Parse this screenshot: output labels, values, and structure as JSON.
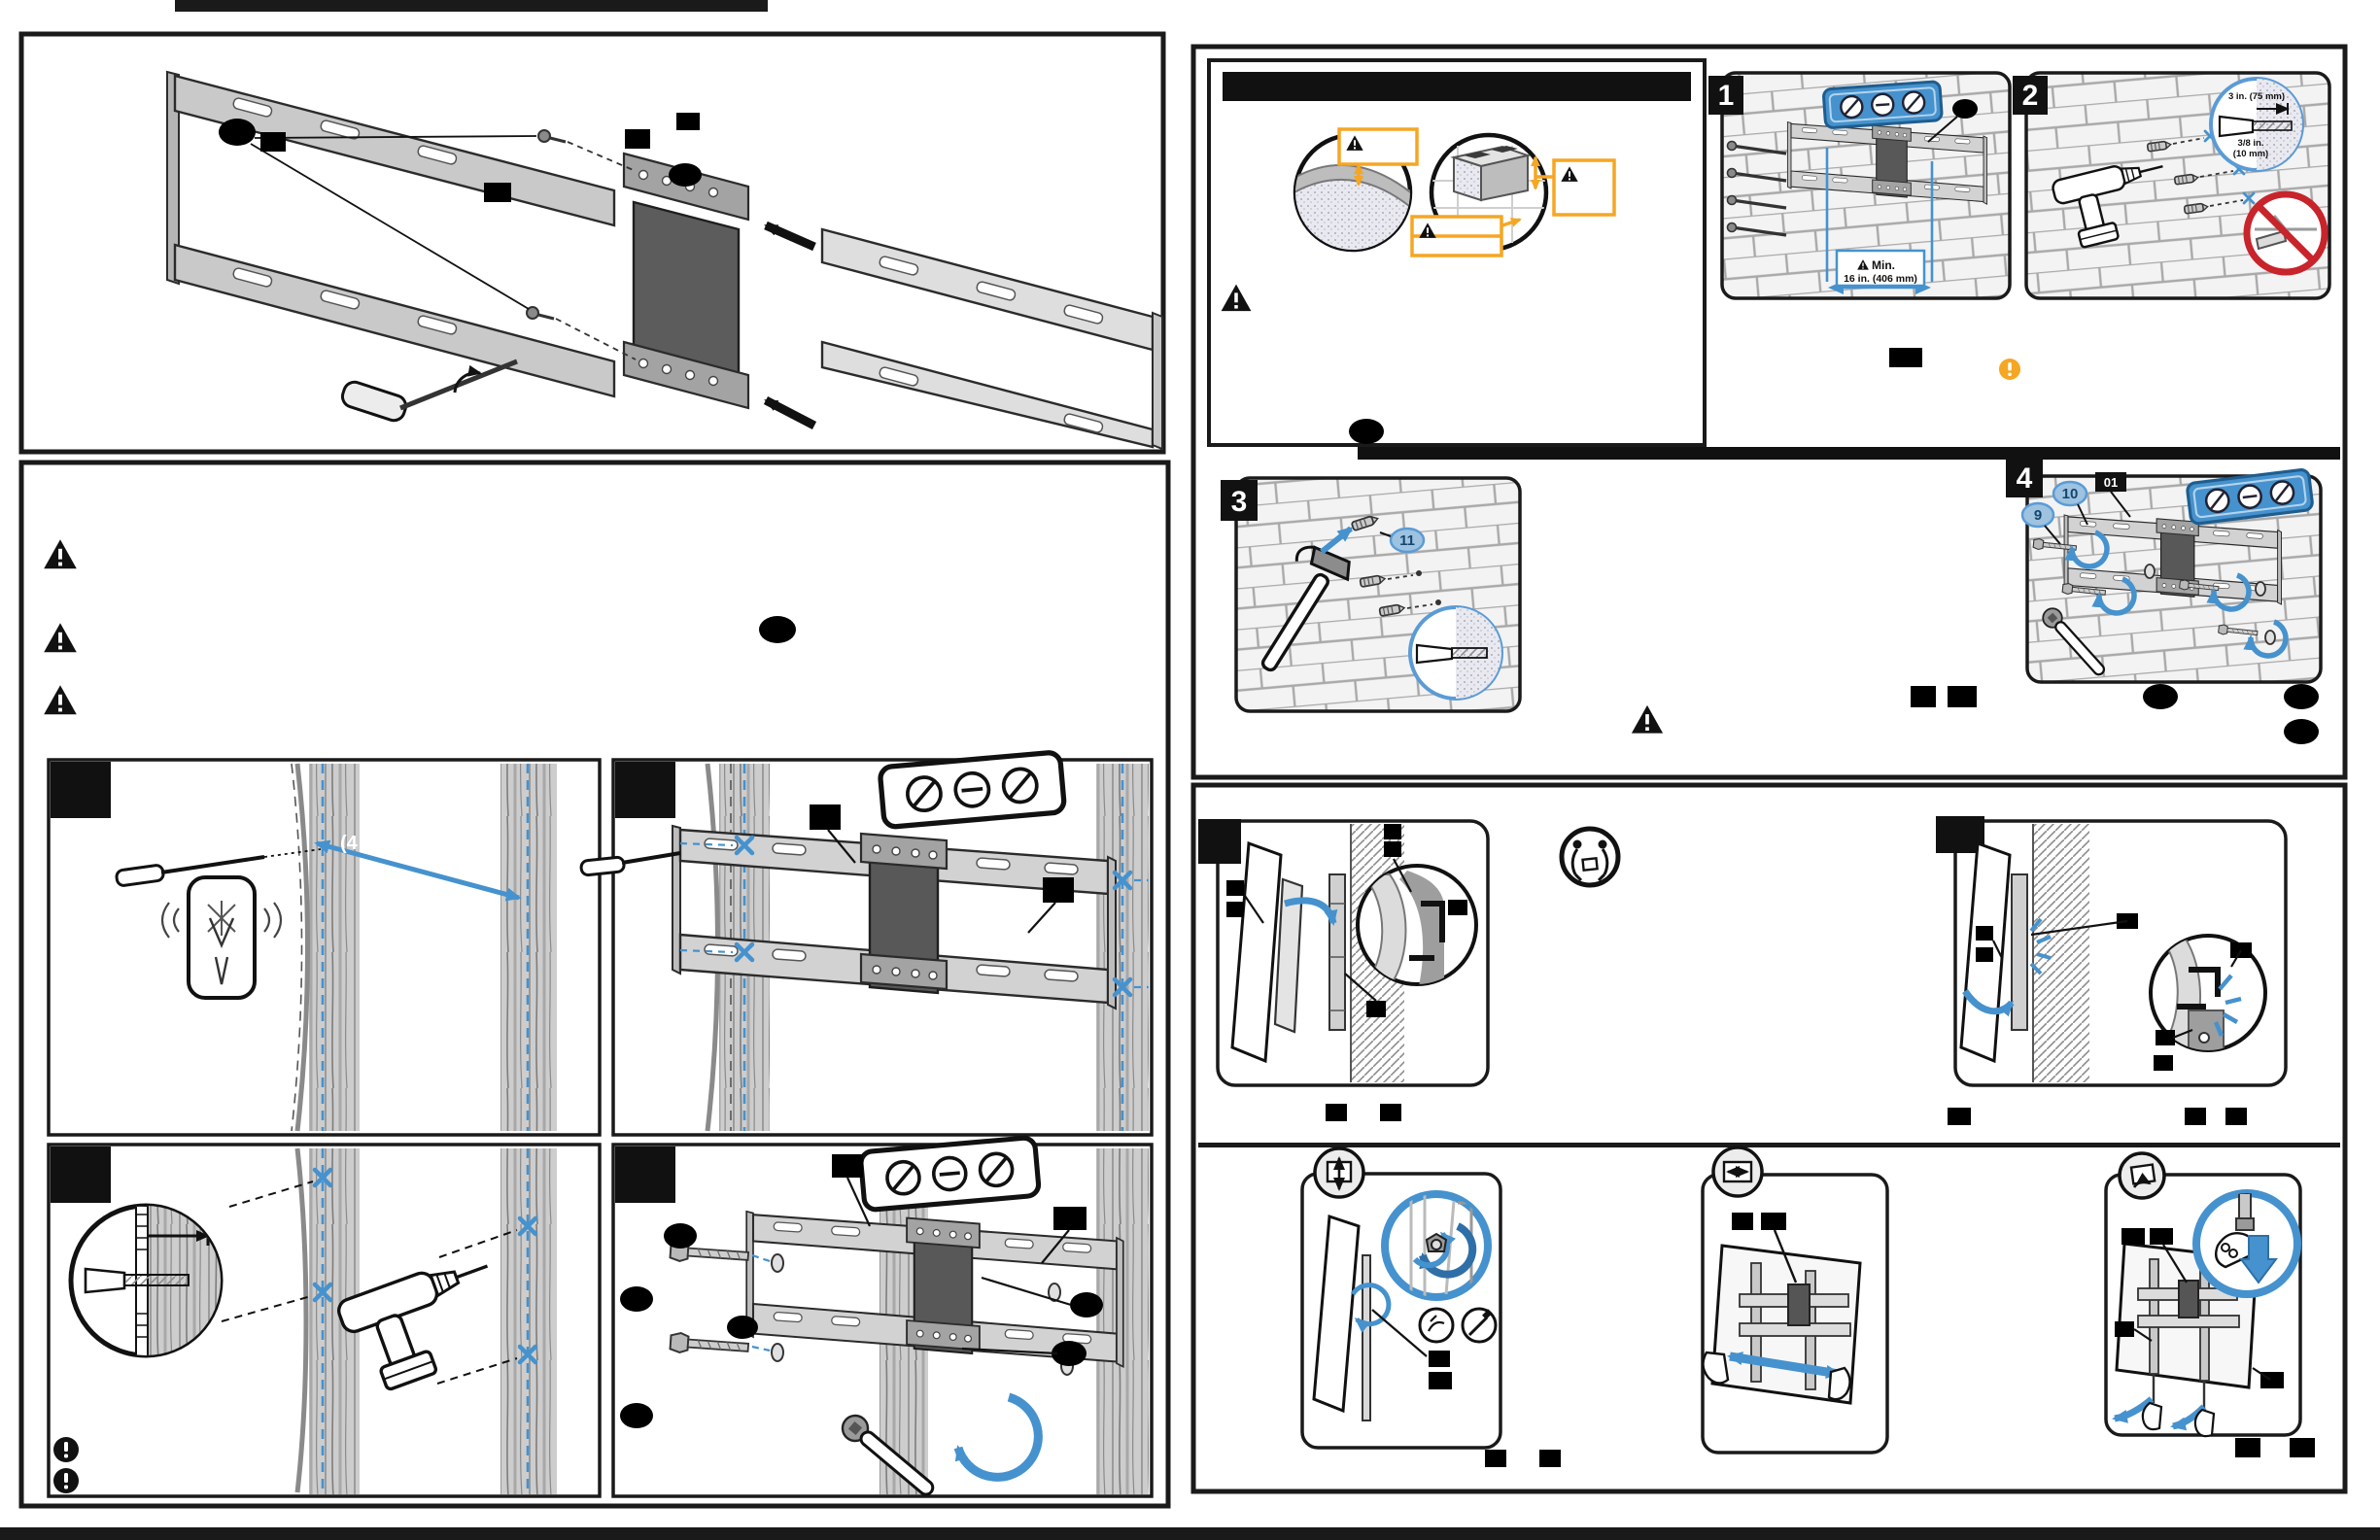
{
  "document": {
    "kind": "tv-wall-mount-installation-manual-spread",
    "note": "two manual pages; most body text redacted with black bars/ellipses"
  },
  "colors": {
    "ink": "#111111",
    "accent_blue": "#4592CE",
    "accent_blue_dark": "#2F6FA8",
    "callout_orange": "#F5A623",
    "prohibition_red": "#C8242B",
    "rail_gray": "#cfcfcf",
    "adapter_gray": "#585858"
  },
  "steps": {
    "s1": "1",
    "s2": "2",
    "s3": "3",
    "s4": "4"
  },
  "measurements": {
    "min_label": "Min.",
    "min_spacing": "16 in. (406 mm)",
    "anchor_depth": "3 in. (75 mm)",
    "drill_bit_line1": "3/8 in.",
    "drill_bit_line2": "(10 mm)",
    "stud_marking_fragment": "(4"
  },
  "part_callouts": {
    "lag_bolt": "9",
    "washer": "10",
    "wall_anchor": "11",
    "wall_plate": "01"
  },
  "icons": {
    "warning_triangle": "warning-triangle",
    "exclamation_circle_black": "note-exclamation",
    "exclamation_circle_orange": "caution-exclamation",
    "two_person_lift": "two-person-lift",
    "no_drill_mortar": "prohibition-no-drill",
    "tilt_adjust": "tilt-adjust",
    "slide_adjust": "horizontal-slide",
    "remove_tv": "remove-tv"
  }
}
